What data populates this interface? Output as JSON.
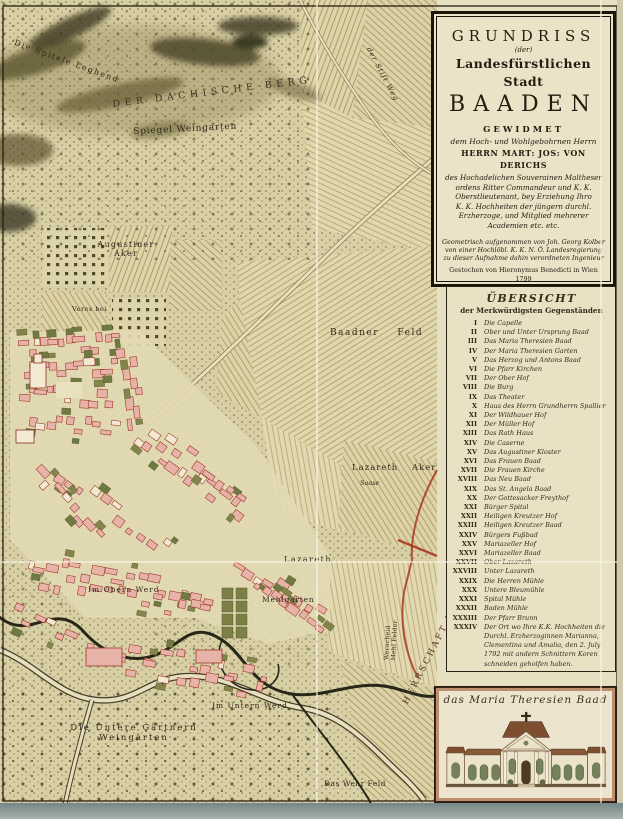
{
  "palette": {
    "paper": "#e3daba",
    "ink": "#32291a",
    "building_pink": "#e7b3a8",
    "building_outline": "#9e3a2b",
    "garden_green": "#7c8045",
    "field_tan": "#ddd3a6",
    "boundary_red": "#a83a20",
    "backing_gray": "#8fa0a0"
  },
  "cartouche": {
    "line_grundriss": "GRUNDRISS",
    "line_der": "(der)",
    "line_stadt": "Landesfürstlichen Stadt",
    "line_baaden": "BAADEN",
    "gewidmet": "GEWIDMET",
    "dedicatee_intro": "dem Hoch- und Wohlgebohrnen Herrn",
    "dedicatee": "HERRN MART: JOS: VON DERICHS",
    "dedication_lines": [
      "des Hochadelichen Souverainen Maltheser",
      "ordens Ritter Commandeur und K. K.",
      "Oberstlieutenant, bey Erziehung Ihro",
      "K. K. Hochheiten der jüngern durchl.",
      "Erzherzoge, und Mitglied mehrerer",
      "Academien etc. etc."
    ],
    "imprint_lines": [
      "Geometrisch aufgenommen von Joh. Georg Kolber",
      "von einer Hochlöbl. K. K. N. Ö. Landesregierung",
      "zu dieser Aufnahme dahin verordneten Ingenieur"
    ],
    "engraver_line": "Gestochen von Hieronymus Benedicti in Wien 1799"
  },
  "legend": {
    "title": "ÜBERSICHT",
    "subtitle": "der Merkwürdigsten Gegenständen",
    "items": [
      {
        "numeral": "I",
        "label": "Die Capelle"
      },
      {
        "numeral": "II",
        "label": "Ober und Unter Ursprung Baad"
      },
      {
        "numeral": "III",
        "label": "Das Maria Theresien Baad"
      },
      {
        "numeral": "IV",
        "label": "Der Maria Theresien Garten"
      },
      {
        "numeral": "V",
        "label": "Das Herzog und Antons Baad"
      },
      {
        "numeral": "VI",
        "label": "Die Pfarr Kirchen"
      },
      {
        "numeral": "VII",
        "label": "Der Ober Hof"
      },
      {
        "numeral": "VIII",
        "label": "Die Burg"
      },
      {
        "numeral": "IX",
        "label": "Das Theater"
      },
      {
        "numeral": "X",
        "label": "Haus des Herrn Grundherrn Spallier"
      },
      {
        "numeral": "XI",
        "label": "Der Wildhauer Hof"
      },
      {
        "numeral": "XII",
        "label": "Der Müller Hof"
      },
      {
        "numeral": "XIII",
        "label": "Das Rath Haus"
      },
      {
        "numeral": "XIV",
        "label": "Die Caserne"
      },
      {
        "numeral": "XV",
        "label": "Das Augustiner Kloster"
      },
      {
        "numeral": "XVI",
        "label": "Das Frauen Baad"
      },
      {
        "numeral": "XVII",
        "label": "Die Frauen Kirche"
      },
      {
        "numeral": "XVIII",
        "label": "Das Neu Baad"
      },
      {
        "numeral": "XIX",
        "label": "Das St. Angela Baad"
      },
      {
        "numeral": "XX",
        "label": "Der Gottesacker Freythof"
      },
      {
        "numeral": "XXI",
        "label": "Bürger Spital"
      },
      {
        "numeral": "XXII",
        "label": "Heiligen Kreutzer Hof"
      },
      {
        "numeral": "XXIII",
        "label": "Heiligen Kreutzer Baad"
      },
      {
        "numeral": "XXIV",
        "label": "Bürgers Fußbad"
      },
      {
        "numeral": "XXV",
        "label": "Mariazeller Hof"
      },
      {
        "numeral": "XXVI",
        "label": "Mariazeller Baad"
      },
      {
        "numeral": "XXVII",
        "label": "Ober Lazareth"
      },
      {
        "numeral": "XXVIII",
        "label": "Unter Lazareth"
      },
      {
        "numeral": "XXIX",
        "label": "Die Herren Mühle"
      },
      {
        "numeral": "XXX",
        "label": "Untere Bleumühle"
      },
      {
        "numeral": "XXXI",
        "label": "Spital Mühle"
      },
      {
        "numeral": "XXXII",
        "label": "Baden Mühle"
      },
      {
        "numeral": "XXXIII",
        "label": "Der Pfarr Brunn"
      },
      {
        "numeral": "XXXIV",
        "label": "Der Ort wo Ihre K.K. Hochheiten die Durchl. Erzherzoginnen Marianna, Clementina und Amalia, den 2. July 1792 mit andern Schnittern Koren schneiden geholfen haben."
      }
    ]
  },
  "inset": {
    "caption": "das Maria Theresien Baad"
  },
  "map_labels": [
    {
      "id": "spitele",
      "text": "Die Spitele Leghend"
    },
    {
      "id": "berg",
      "text": "DER DACHISCHE BERG"
    },
    {
      "id": "spiegel",
      "text": "Spiegel Weingarten"
    },
    {
      "id": "stift-weg",
      "text": "der Stift Weg"
    },
    {
      "id": "augustiner-aker",
      "text": "Augustiner\nAker"
    },
    {
      "id": "veres-bei",
      "text": "Veres bei"
    },
    {
      "id": "baadner-feld",
      "text": "Baadner Feld"
    },
    {
      "id": "lazareth-aker",
      "text": "Lazareth Aker"
    },
    {
      "id": "saase",
      "text": "Saase"
    },
    {
      "id": "lazareth",
      "text": "Lazareth"
    },
    {
      "id": "im-obern-werd",
      "text": "Im Obern Werd"
    },
    {
      "id": "mehlgarten",
      "text": "Mehlgarten"
    },
    {
      "id": "herrschaft-leesdorf",
      "text": "HERRSCHAFT LEESDORF"
    },
    {
      "id": "im-untern-werd",
      "text": "Im Untern Werd"
    },
    {
      "id": "untere-gaertnern",
      "text": "Die Untere Gärtnern\nWeingärten"
    },
    {
      "id": "das-wehr-feld",
      "text": "Das Wehr Feld"
    },
    {
      "id": "weracheid",
      "text": "Weracheid\nMehl Felder"
    }
  ]
}
